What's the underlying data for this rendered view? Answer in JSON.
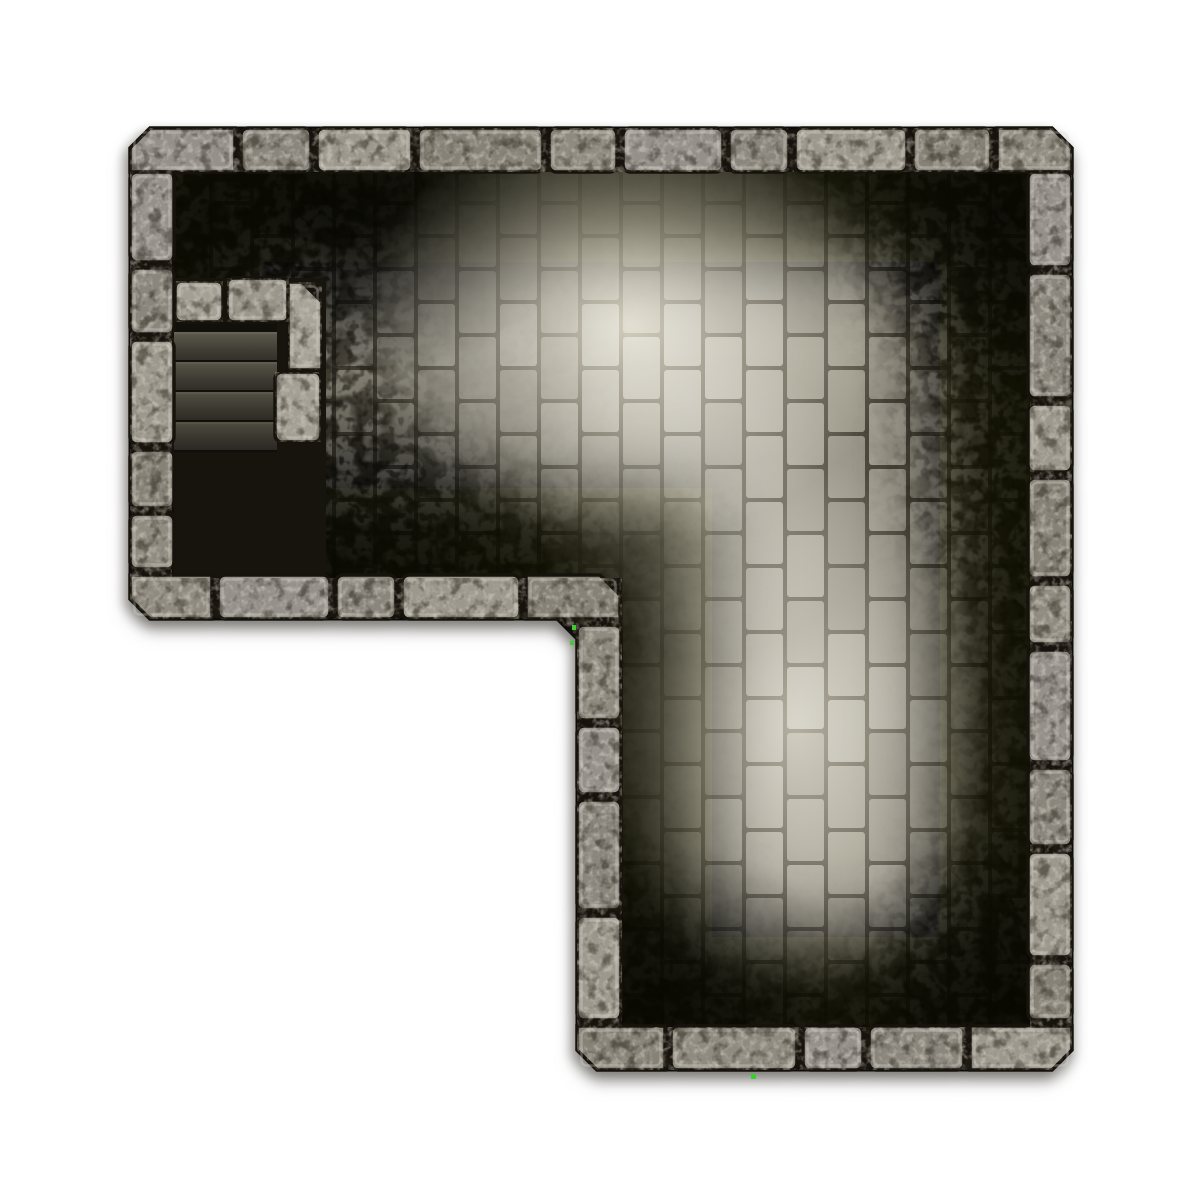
{
  "meta": {
    "scene": "Top-down dungeon battle map tile",
    "room_shape": "L-shaped stone room",
    "features": [
      "stone block outer walls",
      "vertical running-bond brick floor",
      "cobblestone shadow mottling",
      "corner staircase with quarter-turn fan steps",
      "low stone parapet around stairwell"
    ]
  },
  "canvas": {
    "w": 1200,
    "h": 1200,
    "bg": "#ffffff"
  },
  "colors": {
    "seam": "#16130d",
    "outline": "#0d0b08",
    "wall_palette": [
      "#94908a",
      "#8a867e",
      "#9c988e",
      "#868278",
      "#8f8b81"
    ],
    "wall_highlight": "rgba(225,221,210,0.32)",
    "speckle_light": "#ded9ca",
    "speckle_dark": "#262219",
    "mortar": "#4e4a3e",
    "brick_palette": [
      "#a19d90",
      "#989487",
      "#a5a194",
      "#918d80",
      "#9c9889"
    ],
    "mottle_coarse": "#262319",
    "mottle_fine": "#1b1912",
    "vignette": "#0a0906",
    "pit": "#17140e",
    "step_grad": [
      "#615d50",
      "#575448",
      "#413e35",
      "#322f29"
    ],
    "step_sep": "#12100b",
    "step_highlight": "#6e6a5b",
    "fan_fills": [
      "#4d4940",
      "#454138",
      "#3d3a31",
      "#35332b",
      "#2d2b24"
    ],
    "fan_edge": "#757160",
    "parapet_palette": [
      "#a39f95",
      "#9a968c",
      "#a7a399"
    ],
    "artifact_green": "#3ecb32",
    "light": "#efe9d4"
  },
  "geometry": {
    "outer_path": "M150,128 H1052 L1072,148 V1050 L1052,1070 H597 L577,1050 V639 L557,619 H150 L130,599 V148 Z",
    "floor_path": "M172,172 H1030 V1027 H622 V578 H172 Z",
    "floor_bounds": {
      "x": 172,
      "y": 172,
      "maxx": 1030,
      "maxy": 1027
    }
  },
  "walls": {
    "thickness": 44,
    "gap": 6,
    "radius": 7,
    "chamfer": 20,
    "segments": [
      {
        "name": "top",
        "dir": "h",
        "x": 130,
        "y": 128,
        "blocks": [
          {
            "w": 105,
            "ch": "nw"
          },
          {
            "w": 70
          },
          {
            "w": 95
          },
          {
            "w": 125
          },
          {
            "w": 68
          },
          {
            "w": 100
          },
          {
            "w": 60
          },
          {
            "w": 112
          },
          {
            "w": 78
          },
          {
            "w": 75,
            "ch": "ne"
          }
        ]
      },
      {
        "name": "left",
        "dir": "v",
        "x": 130,
        "y": 172,
        "blocks": [
          {
            "w": 90
          },
          {
            "w": 66
          },
          {
            "w": 104
          },
          {
            "w": 58
          },
          {
            "w": 55
          }
        ]
      },
      {
        "name": "right",
        "dir": "v",
        "x": 1028,
        "y": 172,
        "blocks": [
          {
            "w": 95
          },
          {
            "w": 125
          },
          {
            "w": 68
          },
          {
            "w": 100
          },
          {
            "w": 60
          },
          {
            "w": 112
          },
          {
            "w": 78
          },
          {
            "w": 105
          },
          {
            "w": 57
          }
        ]
      },
      {
        "name": "left-wing-bottom",
        "dir": "h",
        "x": 130,
        "y": 575,
        "blocks": [
          {
            "w": 82,
            "ch": "sw"
          },
          {
            "w": 112
          },
          {
            "w": 60
          },
          {
            "w": 118
          },
          {
            "w": 94,
            "ch": "ne"
          }
        ]
      },
      {
        "name": "lower-wing-left",
        "dir": "v",
        "x": 577,
        "y": 625,
        "blocks": [
          {
            "w": 95
          },
          {
            "w": 68
          },
          {
            "w": 110
          },
          {
            "w": 104
          }
        ]
      },
      {
        "name": "bottom",
        "dir": "h",
        "x": 577,
        "y": 1026,
        "blocks": [
          {
            "w": 88,
            "ch": "sw"
          },
          {
            "w": 126
          },
          {
            "w": 60
          },
          {
            "w": 95
          },
          {
            "w": 102,
            "ch": "se"
          }
        ]
      }
    ]
  },
  "floor": {
    "brick": {
      "w": 37,
      "h": 62,
      "rx": 3,
      "col_pitch": 41,
      "row_pitch": 66,
      "half_offset": 33,
      "row_start": 106
    }
  },
  "lighting": {
    "spots": [
      {
        "cx": 630,
        "cy": 325,
        "rx": 270,
        "ry": 215,
        "op": 0.8
      },
      {
        "cx": 795,
        "cy": 725,
        "rx": 195,
        "ry": 270,
        "op": 0.62
      },
      {
        "cx": 705,
        "cy": 505,
        "rx": 170,
        "ry": 150,
        "op": 0.35
      }
    ],
    "dark_spots": [
      {
        "cx": 335,
        "cy": 228,
        "rx": 215,
        "ry": 130,
        "op": 0.62
      },
      {
        "cx": 1002,
        "cy": 215,
        "rx": 150,
        "ry": 155,
        "op": 0.5
      },
      {
        "cx": 1002,
        "cy": 995,
        "rx": 160,
        "ry": 150,
        "op": 0.5
      },
      {
        "cx": 665,
        "cy": 1000,
        "rx": 170,
        "ry": 140,
        "op": 0.5
      },
      {
        "cx": 340,
        "cy": 530,
        "rx": 190,
        "ry": 140,
        "op": 0.42
      },
      {
        "cx": 445,
        "cy": 350,
        "rx": 160,
        "ry": 200,
        "op": 0.25
      }
    ],
    "vignette": {
      "width": 180,
      "opacity": 0.88
    },
    "mask": {
      "edge_width": 200,
      "corner_op": 0.85,
      "hole_op": 0.95
    }
  },
  "stairs": {
    "pit": {
      "x": 174,
      "y": 278,
      "w": 152,
      "h": 300
    },
    "shadow_band": {
      "x": 174,
      "y": 322,
      "w": 103,
      "h": 10
    },
    "steps": {
      "x": 174,
      "y": 332,
      "w": 103,
      "h": 29,
      "count": 4
    },
    "fan": {
      "px": 296,
      "py": 449,
      "r": 310,
      "angles": [
        0,
        24,
        46,
        64,
        79,
        90
      ],
      "clip": {
        "x": 174,
        "y": 448,
        "w": 123,
        "h": 130
      }
    },
    "parapet": [
      {
        "x": 175,
        "y": 281,
        "w": 48,
        "h": 41
      },
      {
        "x": 227,
        "y": 278,
        "w": 62,
        "h": 44
      },
      {
        "x": 288,
        "y": 282,
        "w": 34,
        "h": 88,
        "ch": "ne"
      },
      {
        "x": 275,
        "y": 372,
        "w": 46,
        "h": 70
      }
    ]
  },
  "artifacts": [
    {
      "x": 572,
      "y": 625,
      "w": 4,
      "h": 5
    },
    {
      "x": 570,
      "y": 641,
      "w": 4,
      "h": 4
    },
    {
      "x": 751,
      "y": 1074,
      "w": 5,
      "h": 5
    }
  ]
}
